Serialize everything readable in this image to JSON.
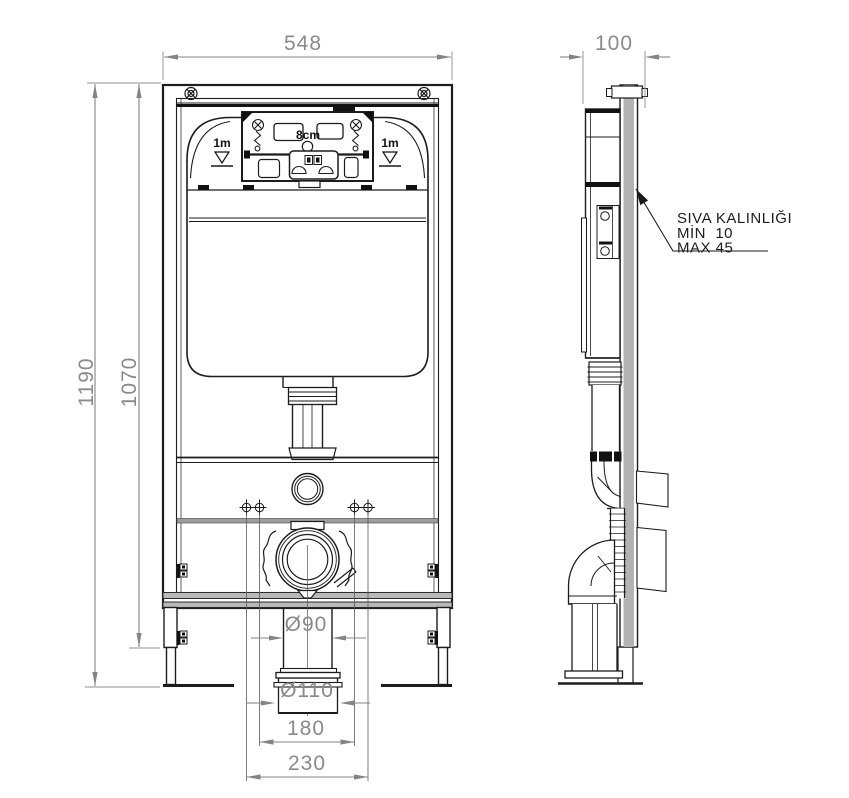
{
  "drawing": {
    "type": "installation-technical-drawing",
    "subject": "concealed-cistern-wc-frame",
    "views": [
      "front-view",
      "side-view"
    ]
  },
  "dimensions": {
    "frame_width": "548",
    "frame_depth": "100",
    "height_overall": "1190",
    "height_inner": "1070",
    "drain_pipe_diameter": "Ø90",
    "drain_connector_diameter": "Ø110",
    "fixing_spacing_inner": "180",
    "fixing_spacing_outer": "230"
  },
  "labels": {
    "offset_label": "8cm",
    "level_mark_left": "1m",
    "level_mark_right": "1m"
  },
  "annotation": {
    "line1": "SIVA KALINLIĞI",
    "line2": "MİN  10",
    "line3": "MAX 45"
  },
  "colors": {
    "line": "#1c1c1c",
    "dimension": "#8a8a8a",
    "fill_gray": "#b3b3b3",
    "background": "#ffffff"
  }
}
